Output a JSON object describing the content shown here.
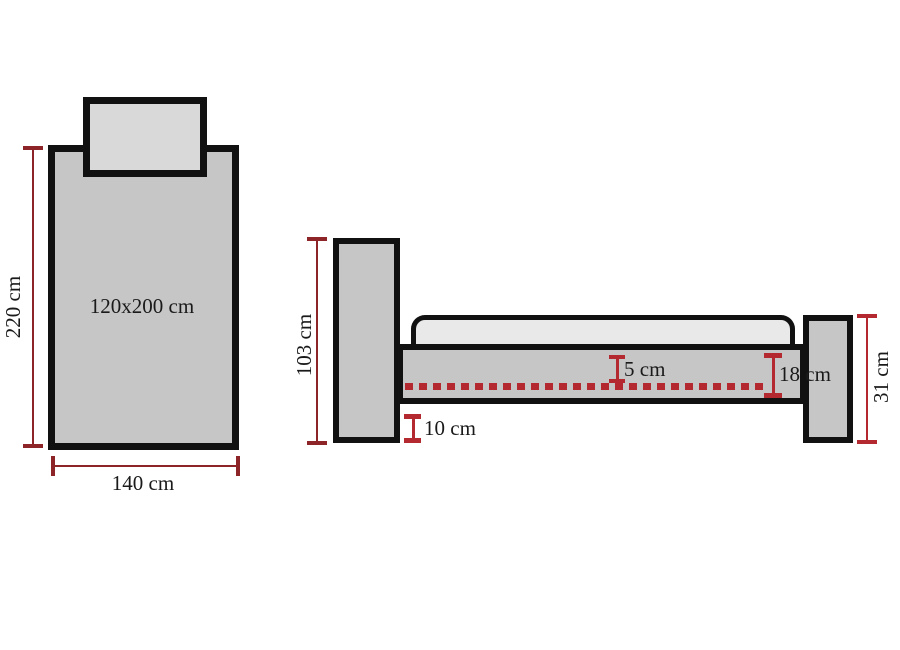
{
  "diagram": {
    "subject": "bed-dimension-drawing",
    "top_view": {
      "surface_label": "120x200 cm",
      "length_label": "220 cm",
      "width_label": "140 cm"
    },
    "side_view": {
      "headboard_height_label": "103 cm",
      "mattress_inset_label": "5 cm",
      "frame_height_label": "18 cm",
      "footboard_height_label": "31 cm",
      "floor_clearance_label": "10 cm"
    },
    "colors": {
      "outline": "#111111",
      "panel_fill": "#c6c6c6",
      "pillow_fill": "#d9d9d9",
      "mattress_fill": "#e9e9e9",
      "dimension_line": "#8d2528",
      "dimension_accent": "#b3292f",
      "background": "#ffffff"
    }
  }
}
